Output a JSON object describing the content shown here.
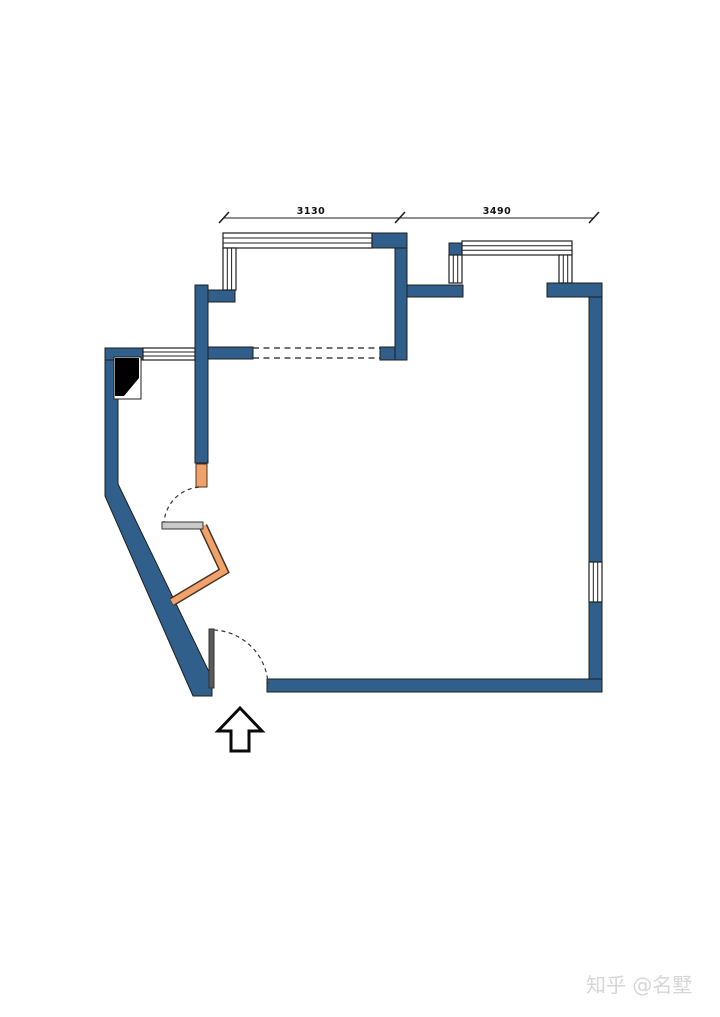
{
  "plan": {
    "dimensions": {
      "left_label": "3130",
      "right_label": "3490"
    },
    "colors": {
      "wall": "#2f5f8a",
      "accent_wall": "#f0a26a",
      "accent_wall_border": "#4a3423",
      "door_leaf": "#c9c9c9",
      "entry_leaf": "#5a5a5a",
      "swing_dash": "#333333",
      "shaft": "#000000"
    },
    "symbols": {
      "entrance_arrow": "up-arrow",
      "door_swing": "dashed-quarter-arc",
      "window": "multi-line-band",
      "shaft": "solid-black-poly"
    }
  },
  "watermark": {
    "text": "知乎 @名墅",
    "color": "#d6d6d6"
  }
}
